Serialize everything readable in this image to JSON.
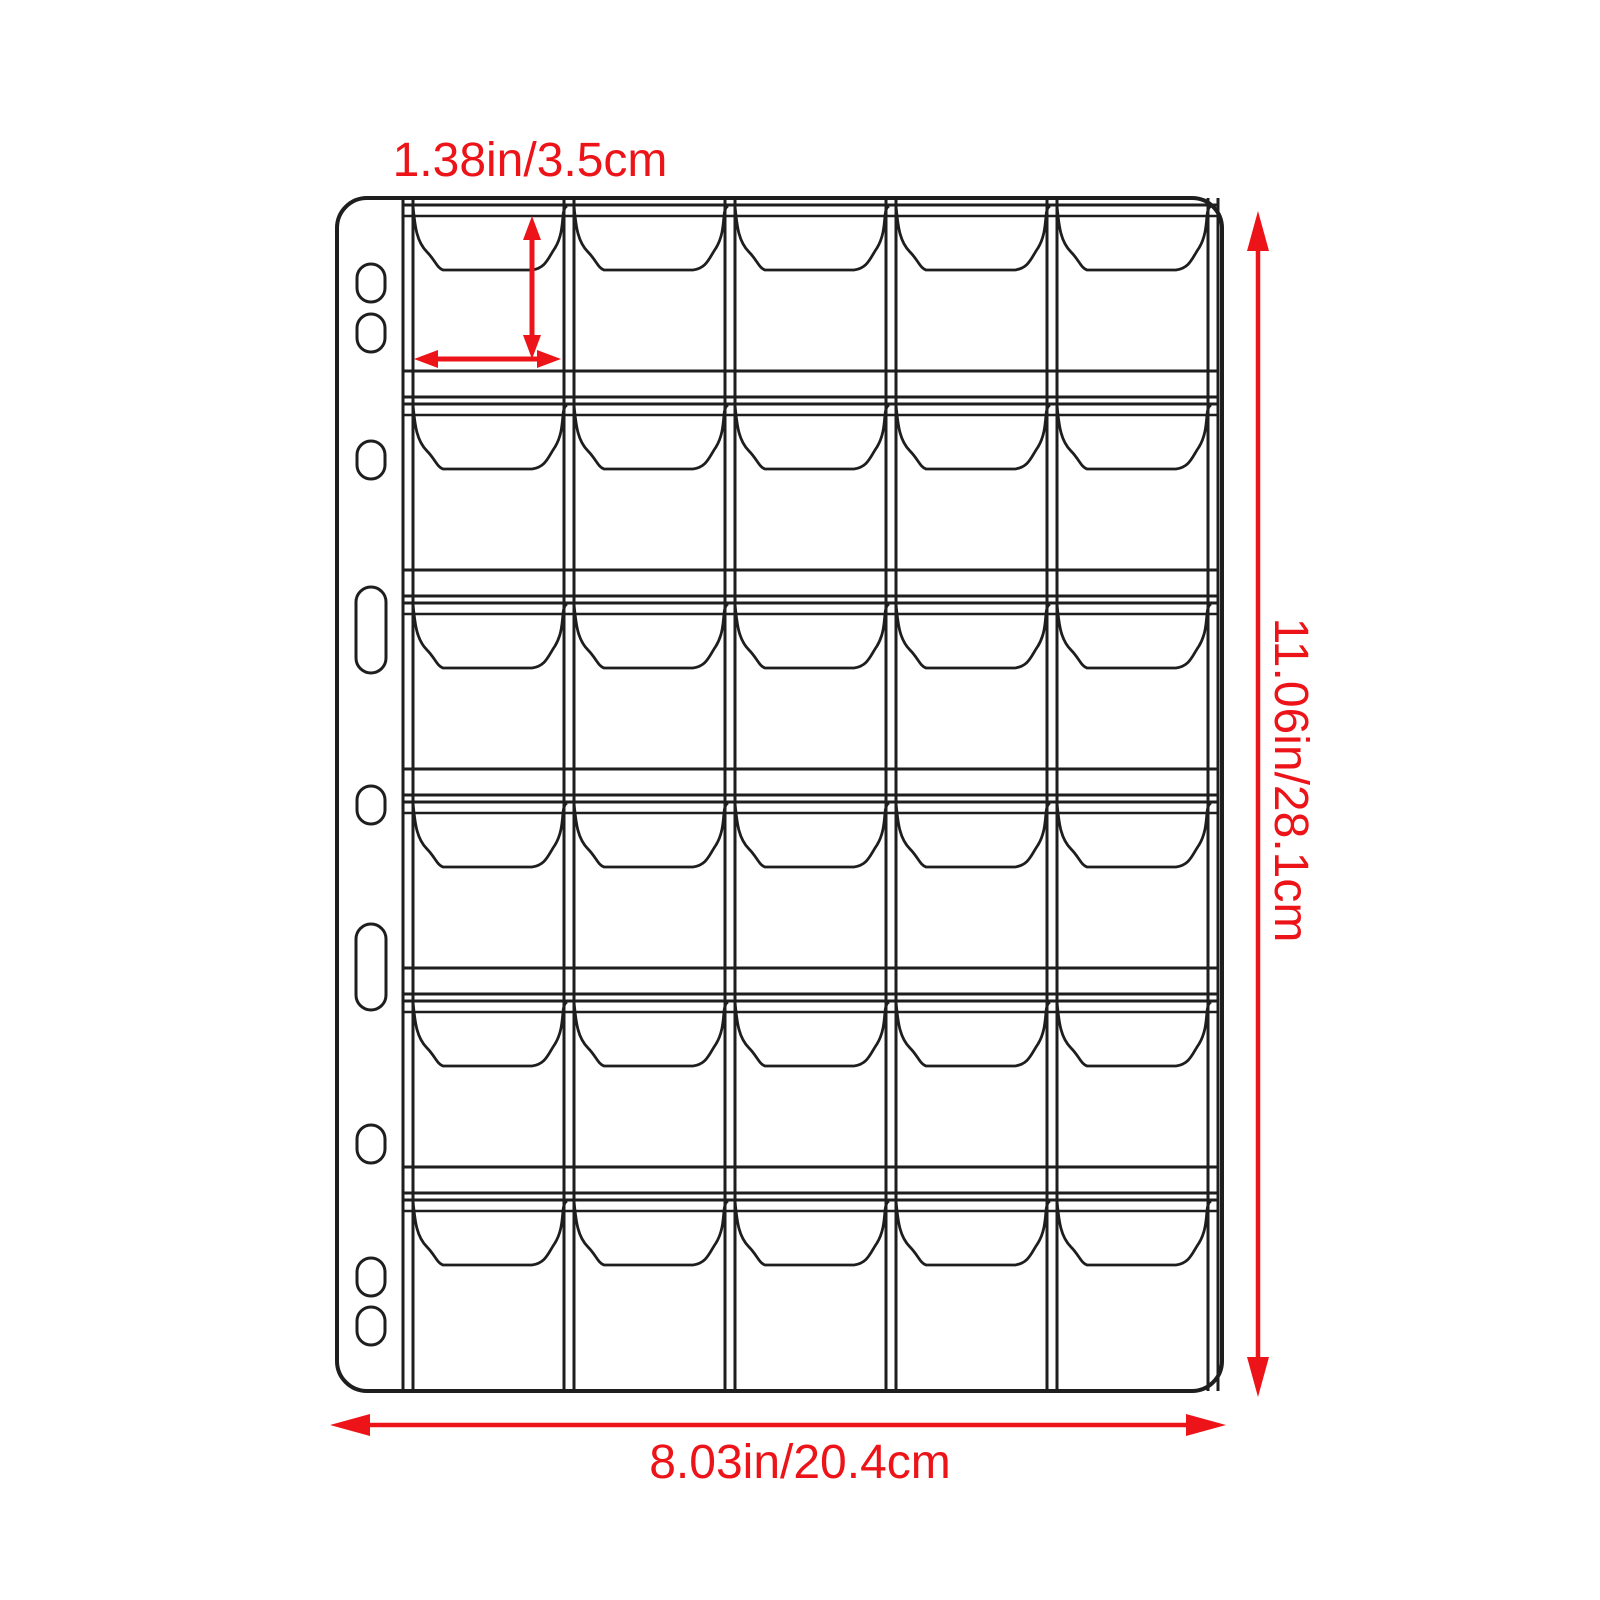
{
  "diagram": {
    "subject": "coin-album-pocket-page-dimension-diagram",
    "labels": {
      "pocket_size": "1.38in/3.5cm",
      "page_height": "11.06in/28.1cm",
      "page_width": "8.03in/20.4cm"
    },
    "colors": {
      "accent": "#ec1418",
      "line": "#1e1e1e",
      "background": "#ffffff"
    },
    "sheet": {
      "x": 337,
      "y": 198,
      "width": 885,
      "height": 1193,
      "corner_radius": 30,
      "edge_stroke": 4,
      "inner_stroke": 3,
      "flap_stroke": 2.8
    },
    "grid": {
      "columns": 5,
      "rows": 6,
      "pocket_count": 30,
      "grid_left": 403,
      "grid_right": 1218,
      "column_pitch": 161,
      "divider_gap": 10,
      "row_top": 198,
      "row_pitch": 199,
      "weld_offset": 7,
      "opening_offset": 18,
      "flap_depth": 72,
      "bottom_line_offset": 173
    },
    "binder_holes": {
      "center_x": 371,
      "small": {
        "width": 28,
        "height": 38
      },
      "slot": {
        "width": 30,
        "height": 86
      },
      "holes": [
        {
          "type": "small",
          "cy": 283
        },
        {
          "type": "small",
          "cy": 333
        },
        {
          "type": "small",
          "cy": 460
        },
        {
          "type": "slot",
          "cy": 630
        },
        {
          "type": "small",
          "cy": 805
        },
        {
          "type": "slot",
          "cy": 967
        },
        {
          "type": "small",
          "cy": 1144
        },
        {
          "type": "small",
          "cy": 1277
        },
        {
          "type": "small",
          "cy": 1326
        }
      ]
    },
    "dimension_arrows": {
      "pocket_vertical": {
        "x1": 532,
        "y1": 216,
        "x2": 532,
        "y2": 359,
        "stroke": 5,
        "head_len": 24,
        "head_half": 9
      },
      "pocket_horizontal": {
        "x1": 414,
        "y1": 359,
        "x2": 561,
        "y2": 359,
        "stroke": 5,
        "head_len": 24,
        "head_half": 9
      },
      "page_height": {
        "x1": 1258,
        "y1": 211,
        "x2": 1258,
        "y2": 1397,
        "stroke": 4.5,
        "head_len": 40,
        "head_half": 11
      },
      "page_width": {
        "x1": 330,
        "y1": 1425,
        "x2": 1226,
        "y2": 1425,
        "stroke": 4.5,
        "head_len": 40,
        "head_half": 11
      }
    },
    "label_positions": {
      "pocket_size": {
        "x": 530,
        "y": 161
      },
      "page_height": {
        "x": 1290,
        "y": 780
      },
      "page_width": {
        "x": 800,
        "y": 1463
      }
    }
  }
}
